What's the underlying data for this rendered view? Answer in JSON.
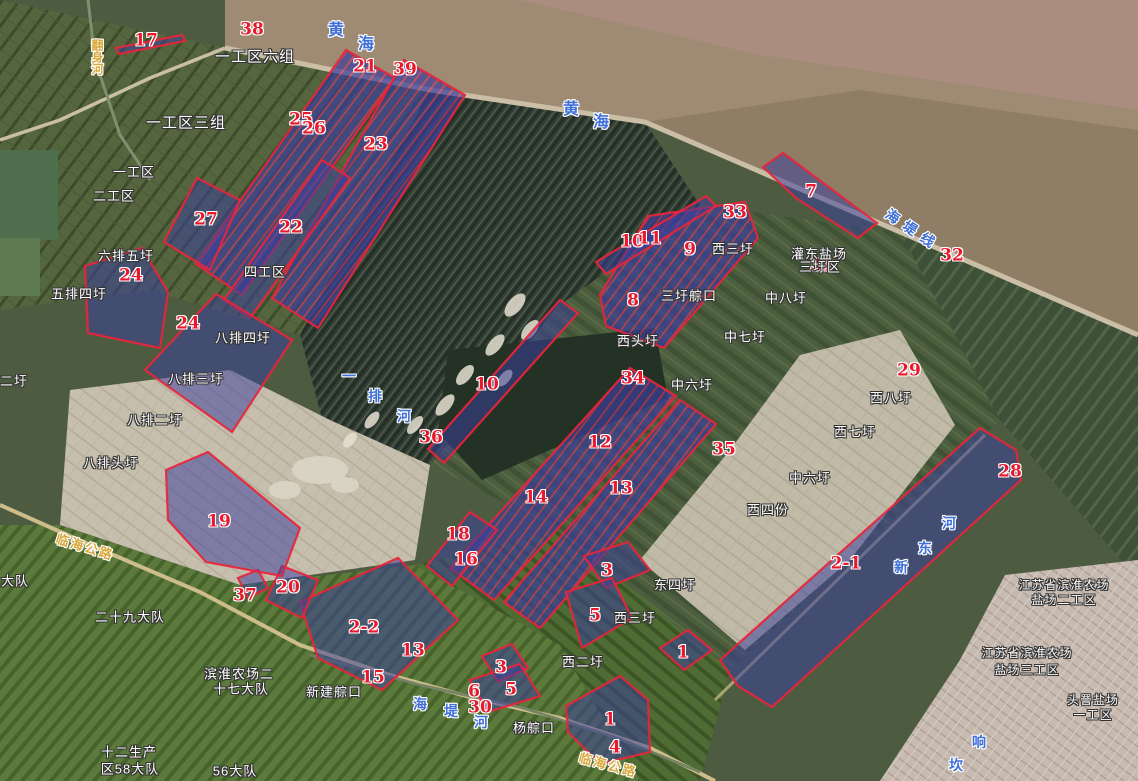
{
  "map": {
    "colors": {
      "parcel_fill": "#3b3f9e",
      "parcel_outline": "#e8253a",
      "number_text": "#e8192c",
      "place_text": "#ffffff",
      "water_text": "#3f6fd8",
      "road_text": "#d9a83c",
      "sea": "#9f8b74"
    },
    "numbers": [
      {
        "text": "17",
        "x": 146,
        "y": 41
      },
      {
        "text": "38",
        "x": 252,
        "y": 30
      },
      {
        "text": "21",
        "x": 365,
        "y": 67
      },
      {
        "text": "39",
        "x": 405,
        "y": 70
      },
      {
        "text": "25",
        "x": 301,
        "y": 120
      },
      {
        "text": "26",
        "x": 314,
        "y": 129
      },
      {
        "text": "23",
        "x": 376,
        "y": 145
      },
      {
        "text": "27",
        "x": 206,
        "y": 220
      },
      {
        "text": "22",
        "x": 291,
        "y": 228
      },
      {
        "text": "24",
        "x": 131,
        "y": 276
      },
      {
        "text": "24",
        "x": 188,
        "y": 324
      },
      {
        "text": "7",
        "x": 811,
        "y": 192
      },
      {
        "text": "33",
        "x": 735,
        "y": 213
      },
      {
        "text": "10",
        "x": 632,
        "y": 242
      },
      {
        "text": "11",
        "x": 650,
        "y": 239
      },
      {
        "text": "9",
        "x": 690,
        "y": 250
      },
      {
        "text": "31",
        "x": 822,
        "y": 266
      },
      {
        "text": "32",
        "x": 952,
        "y": 256
      },
      {
        "text": "8",
        "x": 633,
        "y": 301
      },
      {
        "text": "34",
        "x": 633,
        "y": 379
      },
      {
        "text": "29",
        "x": 909,
        "y": 371
      },
      {
        "text": "10",
        "x": 487,
        "y": 385
      },
      {
        "text": "36",
        "x": 431,
        "y": 438
      },
      {
        "text": "12",
        "x": 600,
        "y": 443
      },
      {
        "text": "35",
        "x": 724,
        "y": 450
      },
      {
        "text": "28",
        "x": 1010,
        "y": 472
      },
      {
        "text": "13",
        "x": 621,
        "y": 489
      },
      {
        "text": "14",
        "x": 536,
        "y": 498
      },
      {
        "text": "18",
        "x": 458,
        "y": 535
      },
      {
        "text": "16",
        "x": 466,
        "y": 560
      },
      {
        "text": "19",
        "x": 219,
        "y": 522
      },
      {
        "text": "2-1",
        "x": 846,
        "y": 564
      },
      {
        "text": "20",
        "x": 288,
        "y": 588
      },
      {
        "text": "37",
        "x": 245,
        "y": 596
      },
      {
        "text": "3",
        "x": 607,
        "y": 571
      },
      {
        "text": "5",
        "x": 595,
        "y": 616
      },
      {
        "text": "1",
        "x": 683,
        "y": 653
      },
      {
        "text": "2-2",
        "x": 364,
        "y": 628
      },
      {
        "text": "13",
        "x": 413,
        "y": 651
      },
      {
        "text": "15",
        "x": 373,
        "y": 678
      },
      {
        "text": "3",
        "x": 501,
        "y": 668
      },
      {
        "text": "6",
        "x": 474,
        "y": 692
      },
      {
        "text": "5",
        "x": 511,
        "y": 690
      },
      {
        "text": "30",
        "x": 480,
        "y": 708
      },
      {
        "text": "1",
        "x": 610,
        "y": 720
      },
      {
        "text": "4",
        "x": 615,
        "y": 748
      }
    ],
    "region_names": [
      {
        "text": "一工区六组",
        "x": 255,
        "y": 57,
        "size": 15
      },
      {
        "text": "一工区三组",
        "x": 186,
        "y": 123,
        "size": 15
      },
      {
        "text": "一工区",
        "x": 134,
        "y": 172
      },
      {
        "text": "二工区",
        "x": 114,
        "y": 196
      },
      {
        "text": "六排五圩",
        "x": 126,
        "y": 256
      },
      {
        "text": "五排四圩",
        "x": 79,
        "y": 294
      },
      {
        "text": "四工区",
        "x": 265,
        "y": 272
      },
      {
        "text": "八排四圩",
        "x": 243,
        "y": 338
      },
      {
        "text": "八排三圩",
        "x": 196,
        "y": 379
      },
      {
        "text": "二圩",
        "x": 14,
        "y": 381
      },
      {
        "text": "八排二圩",
        "x": 155,
        "y": 420
      },
      {
        "text": "八排头圩",
        "x": 111,
        "y": 463
      },
      {
        "text": "西三圩",
        "x": 733,
        "y": 249
      },
      {
        "text": "灌东盐场",
        "x": 819,
        "y": 254
      },
      {
        "text": "三圩区",
        "x": 820,
        "y": 267
      },
      {
        "text": "三圩䑸口",
        "x": 689,
        "y": 296
      },
      {
        "text": "中八圩",
        "x": 786,
        "y": 298
      },
      {
        "text": "西头圩",
        "x": 638,
        "y": 341
      },
      {
        "text": "中七圩",
        "x": 745,
        "y": 337
      },
      {
        "text": "中六圩",
        "x": 692,
        "y": 385
      },
      {
        "text": "西八圩",
        "x": 891,
        "y": 398
      },
      {
        "text": "西七圩",
        "x": 855,
        "y": 432
      },
      {
        "text": "中六圩",
        "x": 810,
        "y": 478
      },
      {
        "text": "西四份",
        "x": 768,
        "y": 510
      },
      {
        "text": "东四圩",
        "x": 675,
        "y": 585
      },
      {
        "text": "西三圩",
        "x": 635,
        "y": 618
      },
      {
        "text": "西二圩",
        "x": 583,
        "y": 662
      },
      {
        "text": "杨䑸口",
        "x": 534,
        "y": 728
      },
      {
        "text": "新建䑸口",
        "x": 334,
        "y": 692
      },
      {
        "text": "二十九大队",
        "x": 130,
        "y": 617
      },
      {
        "text": "大队",
        "x": 15,
        "y": 581
      },
      {
        "text": "滨淮农场二",
        "x": 239,
        "y": 674
      },
      {
        "text": "十七大队",
        "x": 241,
        "y": 689
      },
      {
        "text": "江苏省滨淮农场",
        "x": 1064,
        "y": 585,
        "size": 12
      },
      {
        "text": "盐场二工区",
        "x": 1064,
        "y": 600,
        "size": 12
      },
      {
        "text": "江苏省滨淮农场",
        "x": 1027,
        "y": 653,
        "size": 12
      },
      {
        "text": "盐场三工区",
        "x": 1027,
        "y": 670,
        "size": 12
      },
      {
        "text": "头罾盐场",
        "x": 1093,
        "y": 700,
        "size": 12
      },
      {
        "text": "一工区",
        "x": 1093,
        "y": 715,
        "size": 12
      },
      {
        "text": "十二生产",
        "x": 129,
        "y": 752
      },
      {
        "text": "区58大队",
        "x": 130,
        "y": 769
      },
      {
        "text": "56大队",
        "x": 235,
        "y": 771
      }
    ],
    "waterways": [
      {
        "text": "黄",
        "x": 336,
        "y": 31,
        "size": 16
      },
      {
        "text": "海",
        "x": 366,
        "y": 45,
        "size": 16
      },
      {
        "text": "黄",
        "x": 571,
        "y": 110,
        "size": 16
      },
      {
        "text": "海",
        "x": 601,
        "y": 123,
        "size": 16
      },
      {
        "text": "海堤线",
        "x": 913,
        "y": 230,
        "rot": 34,
        "ls": 7
      },
      {
        "text": "海",
        "x": 420,
        "y": 704
      },
      {
        "text": "堤",
        "x": 451,
        "y": 711
      },
      {
        "text": "河",
        "x": 481,
        "y": 722
      },
      {
        "text": "河",
        "x": 949,
        "y": 523
      },
      {
        "text": "东",
        "x": 925,
        "y": 548
      },
      {
        "text": "新",
        "x": 901,
        "y": 567
      },
      {
        "text": "一",
        "x": 349,
        "y": 376
      },
      {
        "text": "排",
        "x": 375,
        "y": 396
      },
      {
        "text": "河",
        "x": 404,
        "y": 416
      },
      {
        "text": "响",
        "x": 979,
        "y": 742
      },
      {
        "text": "坎",
        "x": 956,
        "y": 765
      }
    ],
    "roads": [
      {
        "text": "临海公路",
        "x": 85,
        "y": 547,
        "rot": 17,
        "ls": 2
      },
      {
        "text": "临海公路",
        "x": 608,
        "y": 765,
        "rot": 15,
        "ls": 2
      },
      {
        "text": "翻身河",
        "x": 97,
        "y": 57,
        "vert": true,
        "size": 12
      }
    ],
    "parcels": [
      {
        "id": "21-25-26",
        "striped": true,
        "pts": [
          [
            346,
            50
          ],
          [
            395,
            78
          ],
          [
            242,
            295
          ],
          [
            196,
            264
          ]
        ]
      },
      {
        "id": "23-39",
        "striped": true,
        "pts": [
          [
            404,
            60
          ],
          [
            465,
            95
          ],
          [
            318,
            328
          ],
          [
            272,
            298
          ]
        ]
      },
      {
        "id": "22",
        "striped": false,
        "pts": [
          [
            322,
            160
          ],
          [
            350,
            178
          ],
          [
            250,
            318
          ],
          [
            224,
            300
          ]
        ]
      },
      {
        "id": "27",
        "striped": false,
        "pts": [
          [
            197,
            178
          ],
          [
            240,
            200
          ],
          [
            210,
            270
          ],
          [
            164,
            242
          ]
        ]
      },
      {
        "id": "24-west",
        "striped": false,
        "pts": [
          [
            85,
            266
          ],
          [
            142,
            248
          ],
          [
            168,
            292
          ],
          [
            160,
            348
          ],
          [
            88,
            333
          ]
        ]
      },
      {
        "id": "24-east",
        "striped": false,
        "pts": [
          [
            216,
            294
          ],
          [
            292,
            340
          ],
          [
            232,
            432
          ],
          [
            145,
            370
          ]
        ]
      },
      {
        "id": "7",
        "striped": false,
        "pts": [
          [
            763,
            167
          ],
          [
            783,
            153
          ],
          [
            877,
            223
          ],
          [
            858,
            238
          ],
          [
            796,
            198
          ]
        ]
      },
      {
        "id": "8-9-33",
        "striped": true,
        "pts": [
          [
            648,
            216
          ],
          [
            745,
            202
          ],
          [
            758,
            238
          ],
          [
            664,
            348
          ],
          [
            606,
            326
          ],
          [
            600,
            295
          ]
        ]
      },
      {
        "id": "10-11",
        "striped": false,
        "pts": [
          [
            596,
            262
          ],
          [
            706,
            196
          ],
          [
            716,
            206
          ],
          [
            606,
            274
          ]
        ]
      },
      {
        "id": "10-center",
        "striped": false,
        "pts": [
          [
            560,
            300
          ],
          [
            578,
            313
          ],
          [
            444,
            463
          ],
          [
            428,
            449
          ]
        ]
      },
      {
        "id": "34-12-14",
        "striped": true,
        "pts": [
          [
            630,
            368
          ],
          [
            676,
            396
          ],
          [
            494,
            600
          ],
          [
            450,
            568
          ]
        ]
      },
      {
        "id": "13",
        "striped": true,
        "pts": [
          [
            680,
            400
          ],
          [
            716,
            424
          ],
          [
            540,
            628
          ],
          [
            504,
            602
          ]
        ]
      },
      {
        "id": "18-16",
        "striped": false,
        "pts": [
          [
            470,
            512
          ],
          [
            497,
            530
          ],
          [
            452,
            586
          ],
          [
            427,
            566
          ]
        ]
      },
      {
        "id": "3-north",
        "striped": false,
        "pts": [
          [
            584,
            556
          ],
          [
            628,
            542
          ],
          [
            650,
            570
          ],
          [
            606,
            588
          ]
        ]
      },
      {
        "id": "5-north",
        "striped": false,
        "pts": [
          [
            566,
            592
          ],
          [
            612,
            578
          ],
          [
            632,
            618
          ],
          [
            582,
            648
          ]
        ]
      },
      {
        "id": "1-east",
        "striped": false,
        "pts": [
          [
            660,
            648
          ],
          [
            688,
            630
          ],
          [
            712,
            650
          ],
          [
            684,
            670
          ]
        ]
      },
      {
        "id": "1-4-south",
        "striped": false,
        "pts": [
          [
            566,
            706
          ],
          [
            620,
            676
          ],
          [
            648,
            700
          ],
          [
            650,
            752
          ],
          [
            600,
            764
          ],
          [
            568,
            732
          ]
        ]
      },
      {
        "id": "3-south",
        "striped": false,
        "pts": [
          [
            482,
            656
          ],
          [
            512,
            644
          ],
          [
            528,
            668
          ],
          [
            498,
            682
          ]
        ]
      },
      {
        "id": "5-6-south",
        "striped": false,
        "pts": [
          [
            470,
            680
          ],
          [
            520,
            664
          ],
          [
            540,
            696
          ],
          [
            488,
            712
          ]
        ]
      },
      {
        "id": "2-2-13-15",
        "striped": false,
        "pts": [
          [
            300,
            602
          ],
          [
            398,
            558
          ],
          [
            458,
            620
          ],
          [
            382,
            690
          ],
          [
            318,
            658
          ]
        ]
      },
      {
        "id": "20",
        "striped": false,
        "pts": [
          [
            266,
            600
          ],
          [
            282,
            566
          ],
          [
            318,
            580
          ],
          [
            302,
            618
          ]
        ]
      },
      {
        "id": "37",
        "striped": false,
        "pts": [
          [
            238,
            578
          ],
          [
            258,
            570
          ],
          [
            268,
            588
          ],
          [
            248,
            598
          ]
        ]
      },
      {
        "id": "19",
        "striped": false,
        "pts": [
          [
            166,
            470
          ],
          [
            208,
            452
          ],
          [
            300,
            528
          ],
          [
            282,
            576
          ],
          [
            206,
            562
          ],
          [
            168,
            520
          ]
        ]
      },
      {
        "id": "2-1-28",
        "striped": false,
        "pts": [
          [
            980,
            428
          ],
          [
            1016,
            450
          ],
          [
            1021,
            480
          ],
          [
            772,
            707
          ],
          [
            738,
            686
          ],
          [
            720,
            660
          ]
        ]
      },
      {
        "id": "17-line",
        "striped": false,
        "pts": [
          [
            116,
            48
          ],
          [
            182,
            35
          ],
          [
            185,
            41
          ],
          [
            119,
            54
          ]
        ]
      }
    ]
  }
}
